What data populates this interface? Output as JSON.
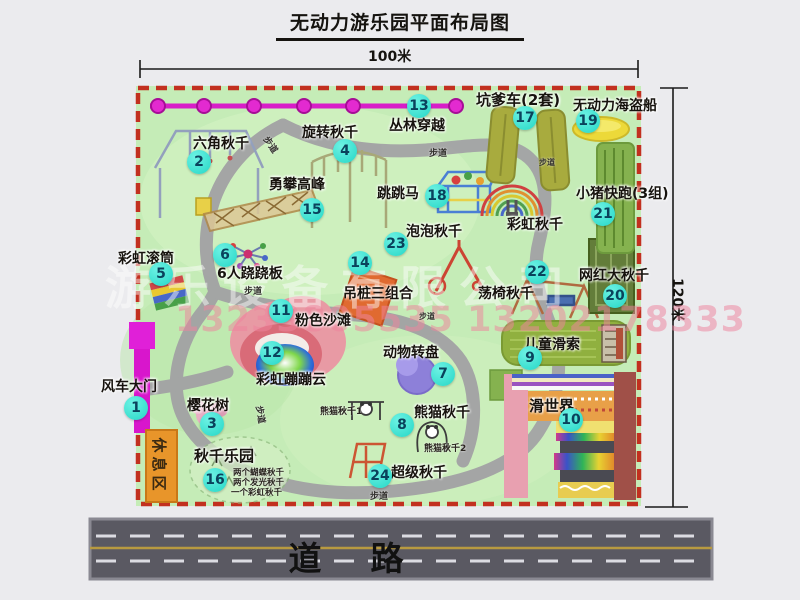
{
  "title": "无动力游乐园平面布局图",
  "dimensions": {
    "top": "100米",
    "right": "120米"
  },
  "watermark": {
    "company": "游乐设备有限公司",
    "phone": "13233805535 13202178333"
  },
  "road": {
    "label": "道　路"
  },
  "labels": {
    "walkway": "步道",
    "rest_area": "休息区",
    "rainbow_swing": "彩虹秋千",
    "panda_swing_1": "熊猫秋千1",
    "panda_swing_2": "熊猫秋千2",
    "swing_park_items": [
      "两个蝴蝶秋千",
      "两个发光秋千",
      "一个彩虹秋千"
    ]
  },
  "attractions": [
    {
      "num": "1",
      "name": "风车大门"
    },
    {
      "num": "2",
      "name": "六角秋千"
    },
    {
      "num": "3",
      "name": "樱花树"
    },
    {
      "num": "4",
      "name": "旋转秋千"
    },
    {
      "num": "5",
      "name": "彩虹滚筒"
    },
    {
      "num": "6",
      "name": "6人跷跷板"
    },
    {
      "num": "7",
      "name": "动物转盘"
    },
    {
      "num": "8",
      "name": "熊猫秋千"
    },
    {
      "num": "9",
      "name": "儿童滑索"
    },
    {
      "num": "10",
      "name": "滑世界"
    },
    {
      "num": "11",
      "name": "粉色沙滩"
    },
    {
      "num": "12",
      "name": "彩虹蹦蹦云"
    },
    {
      "num": "13",
      "name": "丛林穿越"
    },
    {
      "num": "14",
      "name": "吊桩三组合"
    },
    {
      "num": "15",
      "name": "勇攀高峰"
    },
    {
      "num": "16",
      "name": "秋千乐园"
    },
    {
      "num": "17",
      "name": "坑爹车(2套)"
    },
    {
      "num": "18",
      "name": "跳跳马"
    },
    {
      "num": "19",
      "name": "无动力海盗船"
    },
    {
      "num": "20",
      "name": "网红大秋千"
    },
    {
      "num": "21",
      "name": "小猪快跑(3组)"
    },
    {
      "num": "22",
      "name": "荡椅秋千"
    },
    {
      "num": "23",
      "name": "泡泡秋千"
    },
    {
      "num": "24",
      "name": "超级秋千"
    }
  ]
}
